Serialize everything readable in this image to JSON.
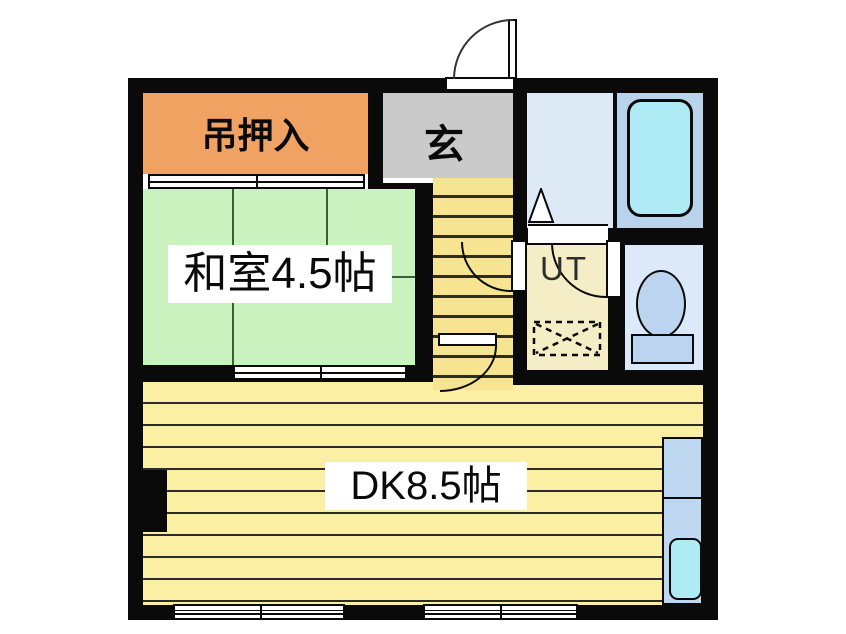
{
  "plan": {
    "type": "apartment-floor-plan",
    "rooms": {
      "closet": {
        "label": "吊押入",
        "color": "#F0A263"
      },
      "entrance": {
        "label": "玄",
        "color": "#CACACA"
      },
      "washitsu": {
        "label": "和室4.5帖",
        "color": "#C9F2BF"
      },
      "utility": {
        "label": "UT",
        "color": "#F5EDC6"
      },
      "dining_kitchen": {
        "label": "DK8.5帖",
        "color": "#FBEFA3"
      },
      "washroom": {
        "label": "",
        "color": "#DDEAF6"
      },
      "bathroom": {
        "label": "",
        "color": "#B9D3EC"
      },
      "toilet": {
        "label": "",
        "color": "#DBE9F8"
      },
      "stairs": {
        "label": "",
        "color": "#F7E493"
      }
    },
    "colors": {
      "wall": "#0a0a0a",
      "bathtub": "#AEEBF4",
      "sink": "#AEEBF4",
      "toilet_fixture": "#BDD4F1",
      "kitchen_counter": "#BFD8F1",
      "background": "#ffffff"
    }
  }
}
